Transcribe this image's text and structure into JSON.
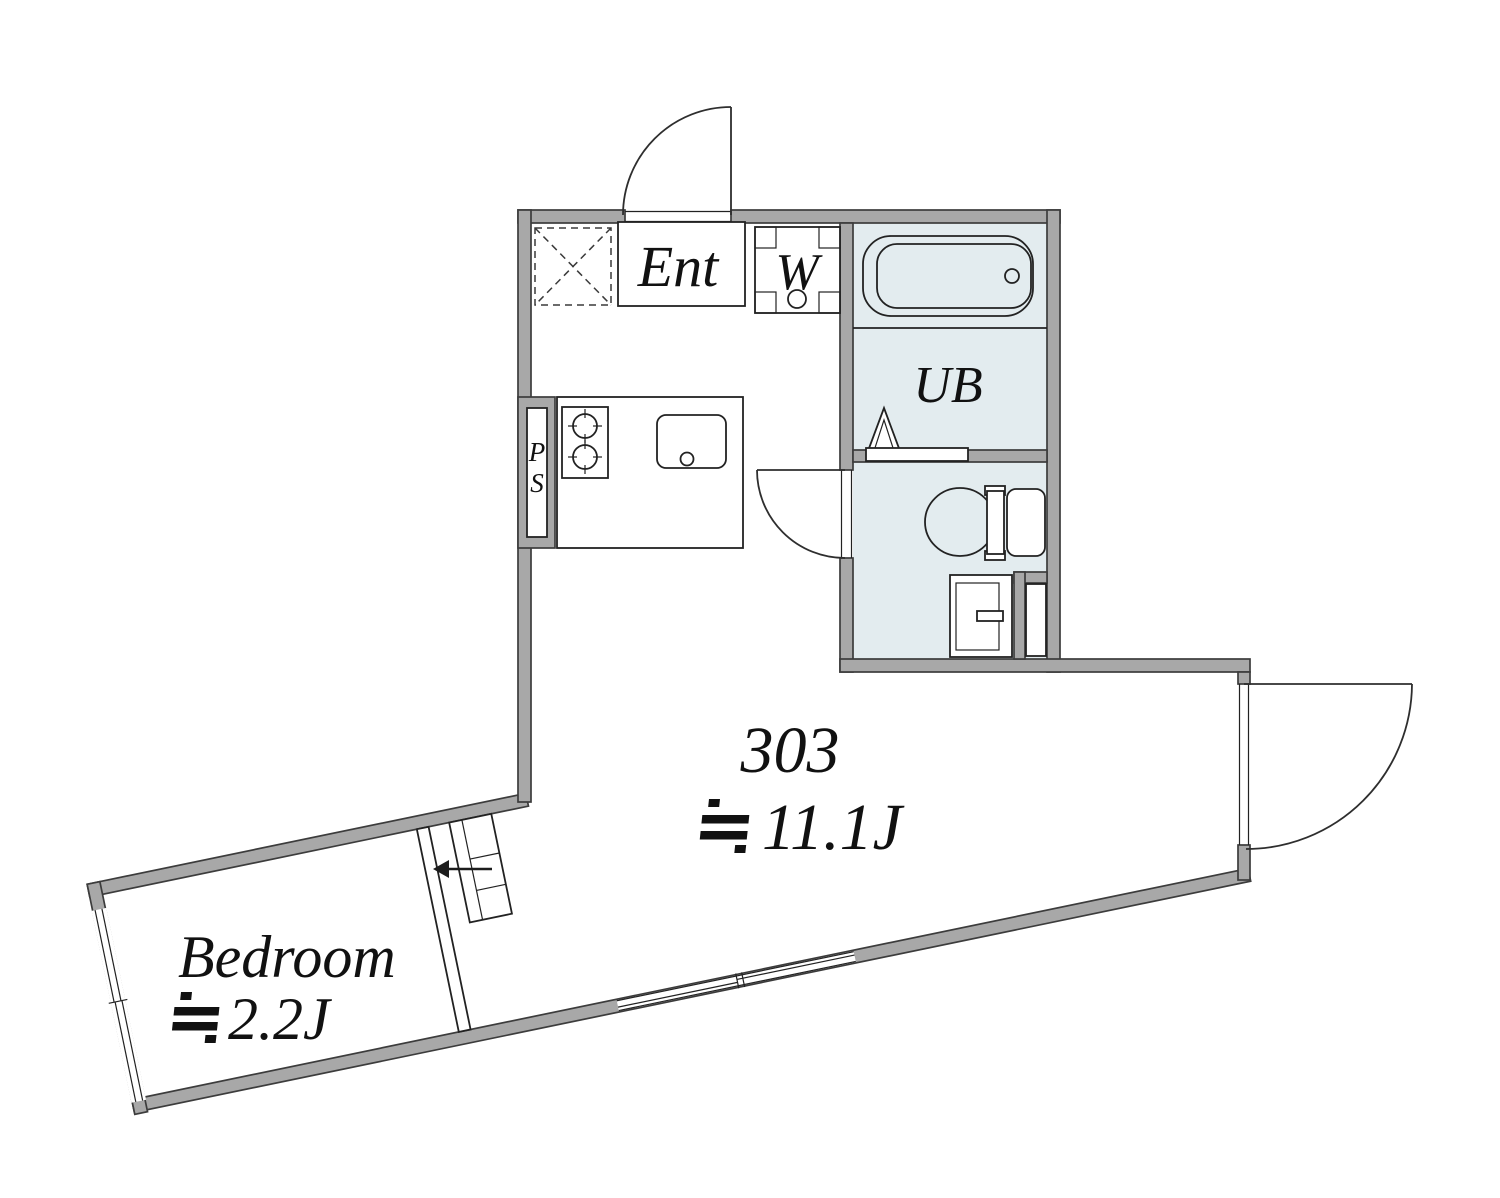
{
  "title": "Apartment floor plan unit 303",
  "colors": {
    "wall": "#a8a8a8",
    "wall_outline": "#3c3c3c",
    "wet_area": "#e3ecef",
    "line": "#222222",
    "text": "#111111"
  },
  "labels": {
    "entrance": "Ent",
    "washer": "W",
    "unit_bath": "UB",
    "pipe_space_p": "P",
    "pipe_space_s": "S",
    "unit_number": "303",
    "approx_symbol": "≒",
    "main_area": "11.1J",
    "bedroom": "Bedroom",
    "bedroom_area": "2.2J"
  },
  "rooms": [
    {
      "name": "entrance-hall",
      "label": "Ent"
    },
    {
      "name": "washer-space",
      "label": "W"
    },
    {
      "name": "unit-bath",
      "label": "UB"
    },
    {
      "name": "toilet-room",
      "label": ""
    },
    {
      "name": "kitchen-living",
      "label": "303 ≒11.1J"
    },
    {
      "name": "bedroom",
      "label": "Bedroom ≒2.2J"
    },
    {
      "name": "pipe-space",
      "label": "PS"
    }
  ]
}
